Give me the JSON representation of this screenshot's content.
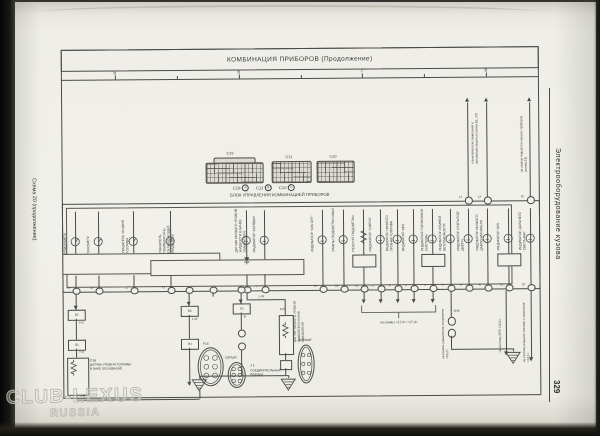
{
  "page": {
    "left_margin_label": "Схема 20 (продолжение).",
    "sidebar_label": "Электрооборудование кузова",
    "page_number": "329",
    "watermark_line1": "CLUB-LEXUS",
    "watermark_line2": "RUSSIA"
  },
  "header": {
    "title": "КОМБИНАЦИЯ ПРИБОРОВ (Продолжение)",
    "ruler": {
      "numbers": [
        {
          "label": "5",
          "x": 116
        },
        {
          "label": "6",
          "x": 240
        },
        {
          "label": "7",
          "x": 363
        },
        {
          "label": "8",
          "x": 487
        }
      ],
      "minor_ticks_x": [
        178,
        302,
        425
      ]
    }
  },
  "connector_block": {
    "connectors": [
      {
        "id": "C19"
      },
      {
        "id": "C11"
      },
      {
        "id": "C10"
      }
    ],
    "legend": [
      {
        "id": "C19",
        "circle": "A"
      },
      {
        "id": "C11",
        "circle": "B"
      },
      {
        "id": "C10",
        "circle": "C"
      }
    ],
    "caption": "БЛОК УПРАВЛЕНИЯ КОМБИНАЦИЕЙ ПРИБОРОВ"
  },
  "cluster": {
    "columns": [
      {
        "x": 75,
        "label": "СПИДОМЕТР",
        "symbol": "gauge",
        "pin": "15"
      },
      {
        "x": 98,
        "label": "ТАХОМЕТР",
        "symbol": "gauge",
        "pin": "16"
      },
      {
        "x": 133,
        "label": "УКАЗАТЕЛЬ УРОВНЯ ТОПЛИВА",
        "symbol": "gauge",
        "pin": "11"
      },
      {
        "x": 170,
        "label": "УКАЗАТЕЛЬ ТЕМПЕРАТУРЫ ОХЛАЖДАЮЩЕЙ ЖИДКОСТИ",
        "symbol": "gauge",
        "pin": "12"
      },
      {
        "x": 246,
        "label": "ДАТЧИК НИЗКОГО УРОВНЯ ЖИДКОСТИ В БАЧКЕ ОМЫВАТЕЛЯ",
        "symbol": "lamp",
        "extra": "diode",
        "pin": "13"
      },
      {
        "x": 264,
        "label": "ИНДИКАТОР ЗАРЯДКИ",
        "symbol": "lamp",
        "pin": "7"
      },
      {
        "x": 322,
        "label": "ИНДИКАТОР \"O/D OFF\"",
        "symbol": "lamp",
        "pin": "10"
      },
      {
        "x": 343,
        "label": "ЛАМПЫ ПОДСВЕТКИ ШКАЛ",
        "symbol": "lamp",
        "pin": "18"
      },
      {
        "x": 363,
        "label": "РЕОСТАТ ПОДСВЕТКИ",
        "symbol": "resistor",
        "extra": "box",
        "pin": "19"
      },
      {
        "x": 380,
        "label": "ИНДИКАТОР \"CHECK\"",
        "symbol": "lamp",
        "pin": "1"
      },
      {
        "x": 397,
        "label": "ИНДИКАТОР НИЗКОГО УРОВНЯ ТОПЛИВА",
        "symbol": "lamp",
        "pin": "2"
      },
      {
        "x": 413,
        "label": "ИНДИКАТОР ABS",
        "symbol": "lamp",
        "pin": "3"
      },
      {
        "x": 432,
        "label": "ИНДИКАТОР ТОРМОЗНОЙ СИСТЕМЫ",
        "symbol": "lamp",
        "extra": "box",
        "pin": "4"
      },
      {
        "x": 450,
        "label": "ИНДИКАТОР РЕМНЕЙ БЕЗОПАСНОСТИ",
        "symbol": "lamp",
        "pin": "5"
      },
      {
        "x": 468,
        "label": "ИНДИКАТОР ОТКРЫТОЙ ДВЕРИ",
        "symbol": "lamp",
        "pin": "6"
      },
      {
        "x": 487,
        "label": "ИНДИКАТОР НИЗКОГО ДАВЛЕНИЯ МАСЛА",
        "symbol": "lamp",
        "pin": "8"
      },
      {
        "x": 508,
        "label": "ИНДИКАТОР SRS",
        "symbol": "lamp",
        "extra": "box",
        "pin": "21"
      },
      {
        "x": 530,
        "label": "ИНДИКАТОР ДАЛЬНЕГО СВЕТА ФАР",
        "symbol": "lamp",
        "pin": "20"
      }
    ]
  },
  "top_wires": {
    "wires": [
      {
        "x": 468,
        "pin": "14"
      },
      {
        "x": 487,
        "pin": "13"
      },
      {
        "x": 530,
        "pin": "20"
      }
    ],
    "pair_label": "к выключателю зажигания и автоматам защиты (схемы 16, 13)",
    "single_label": "на лампы подсветки панели приборов (схема 21)"
  },
  "bottom": {
    "fuel_chain": {
      "box1": "B2",
      "box2": "B1",
      "wire": "Y-G",
      "tag": "F16",
      "label": "ДАТЧИК УРОВНЯ ТОПЛИВА В БАКЕ (ОСНОВНОЙ)",
      "bottom_wire": "1-B"
    },
    "lw_chain": {
      "box1": "B3",
      "box2": "B4",
      "wire": "L-W"
    },
    "k2_chain": {
      "box": "K2",
      "wire": "B"
    },
    "washer": {
      "tag": "F15",
      "label": "ДАТЧИК НИЗКОГО УРОВНЯ ЖИДКОСТИ В БАЧКЕ ОМЫВАТЕЛЯ",
      "wire": "L-W"
    },
    "junction": {
      "tag": "J 1",
      "label": "СОЕДИНИТЕЛЬНЫЙ РАЗЪЕМ",
      "gray": "СЕРЫЙ",
      "black": "ЧЕРНЫЙ",
      "face_tag": "F16"
    },
    "bracket_label": "на схемы <17,4> <17,4>",
    "ground_chain_wire": "W-B",
    "down_labels": [
      "на панель управления отопителем <15,2>",
      "на систему SRS <15,2>",
      "на систему впрыска топлива и зажигания <12,1>"
    ]
  }
}
